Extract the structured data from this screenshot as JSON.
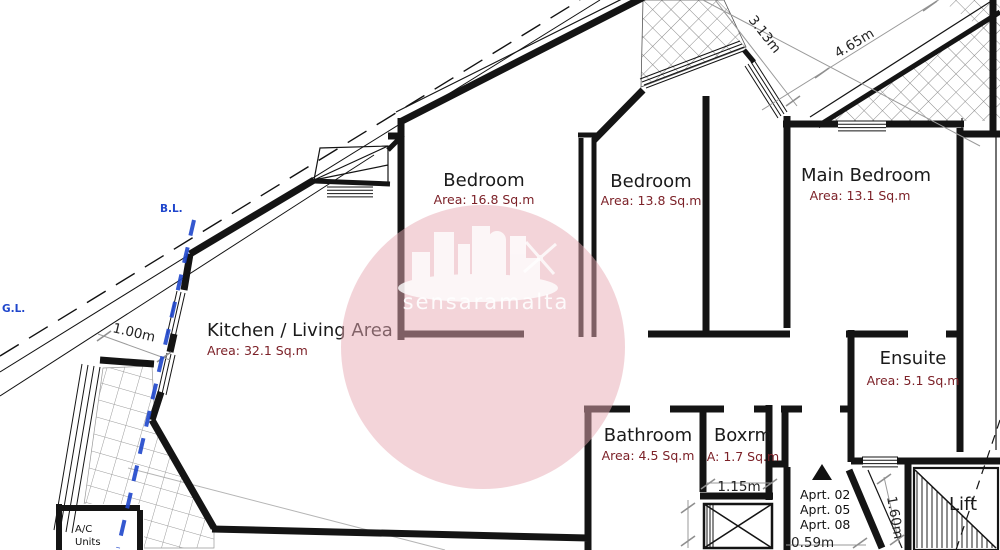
{
  "plan": {
    "watermark_text": "sensaramalta",
    "boundary": {
      "bl_label": "B.L.",
      "gl_label": "G.L."
    },
    "rooms": [
      {
        "name": "Bedroom",
        "area": "Area: 16.8 Sq.m"
      },
      {
        "name": "Bedroom",
        "area": "Area: 13.8 Sq.m"
      },
      {
        "name": "Main Bedroom",
        "area": "Area: 13.1 Sq.m"
      },
      {
        "name": "Kitchen / Living Area",
        "area": "Area: 32.1 Sq.m"
      },
      {
        "name": "Ensuite",
        "area": "Area: 5.1 Sq.m"
      },
      {
        "name": "Bathroom",
        "area": "Area: 4.5 Sq.m"
      },
      {
        "name": "Boxrm",
        "area": "A: 1.7 Sq.m"
      },
      {
        "name": "Lift"
      }
    ],
    "dims": {
      "d313": "3.13m",
      "d465": "4.65m",
      "d100": "1.00m",
      "d115": "1.15m",
      "d059": "0.59m",
      "d160": "1.60m"
    },
    "apartments": [
      "Aprt. 02",
      "Aprt. 05",
      "Aprt. 08"
    ],
    "ac_units": [
      "A/C",
      "Units"
    ],
    "colors": {
      "wall": "#141414",
      "area_text": "#7c2128",
      "boundary_blue": "#1f46cc",
      "dim_gray": "#8f8f8f",
      "watermark_pink": "#e8aab4"
    }
  }
}
